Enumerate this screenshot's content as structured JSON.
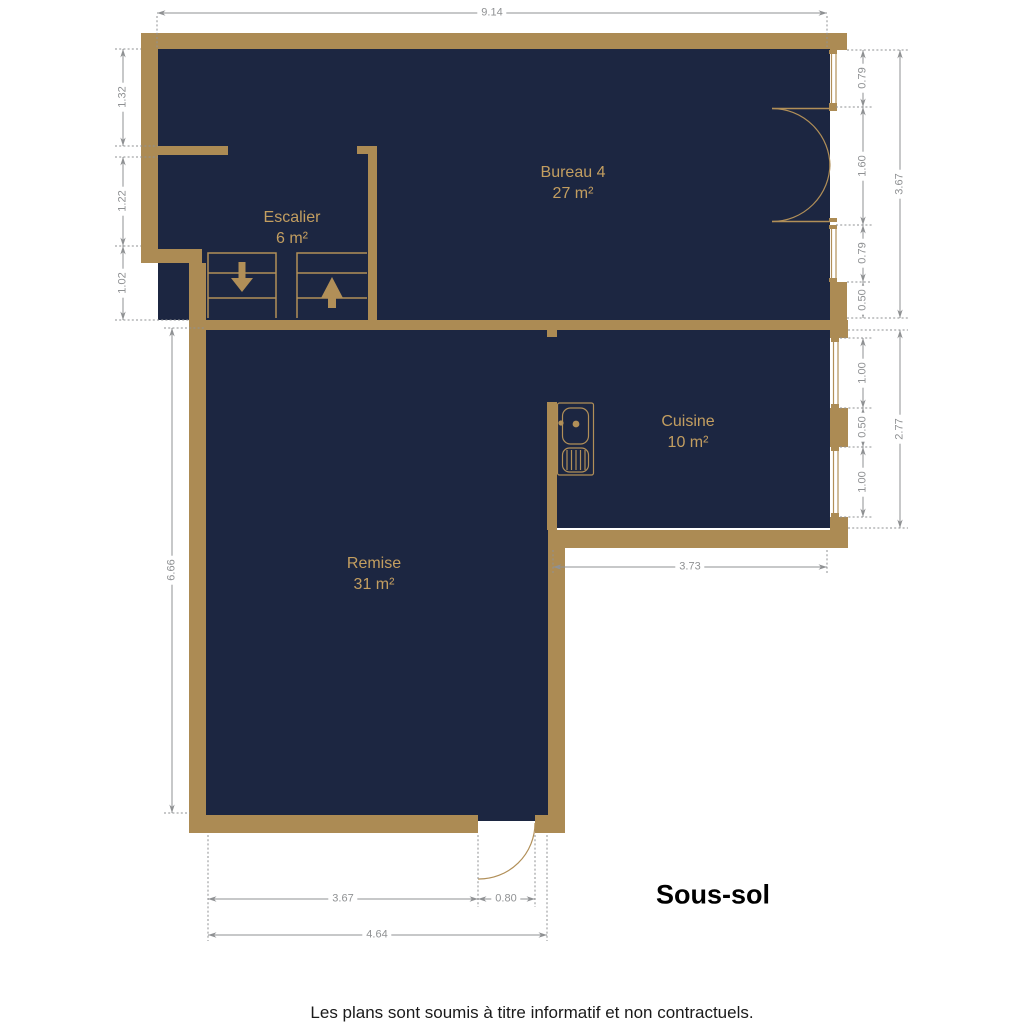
{
  "title": "Sous-sol",
  "disclaimer": "Les plans sont soumis à titre informatif et non contractuels.",
  "rooms": [
    {
      "id": "bureau",
      "name": "Bureau 4",
      "area": "27 m²"
    },
    {
      "id": "escalier",
      "name": "Escalier",
      "area": "6 m²"
    },
    {
      "id": "cuisine",
      "name": "Cuisine",
      "area": "10 m²"
    },
    {
      "id": "remise",
      "name": "Remise",
      "area": "31 m²"
    }
  ],
  "dimensions": {
    "top_width": "9.14",
    "left_upper": "1.32",
    "left_middle": "1.22",
    "left_lower": "1.02",
    "right_window_top": "0.79",
    "right_door": "1.60",
    "right_window_bottom": "0.79",
    "right_wall_segment": "0.50",
    "right_total": "3.67",
    "kitchen_window_top": "1.00",
    "kitchen_wall_segment": "0.50",
    "kitchen_window_bottom": "1.00",
    "kitchen_total": "2.77",
    "kitchen_width": "3.73",
    "remise_height": "6.66",
    "bottom_left": "3.67",
    "bottom_door": "0.80",
    "bottom_total": "4.64"
  },
  "colors": {
    "wall": "#AC8B54",
    "room": "#1C2641",
    "accent": "#C39E60",
    "fixture": "#B18F58",
    "dim": "#8F9193",
    "text": "#111111",
    "bg": "#FFFFFF"
  }
}
